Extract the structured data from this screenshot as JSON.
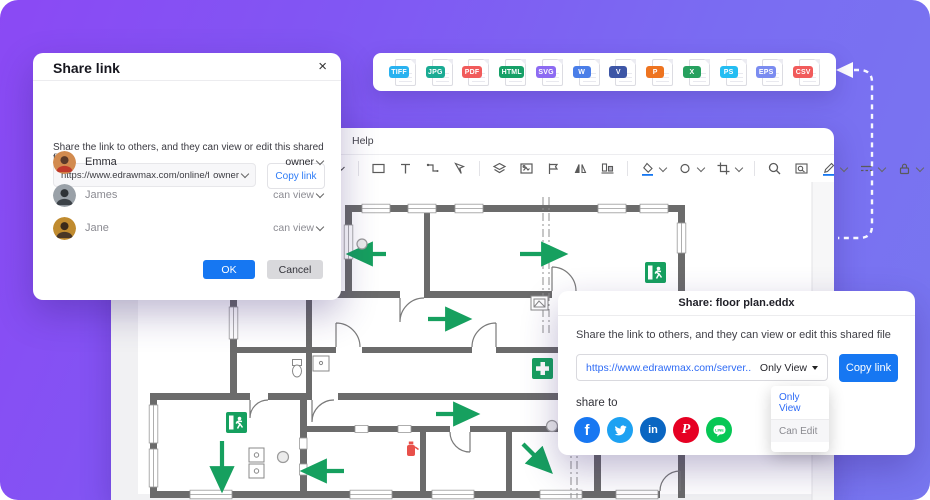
{
  "colors": {
    "accent_blue": "#1677f2",
    "link_blue": "#2e6bf5",
    "plan_green": "#16a05f",
    "wall_gray": "#6b6b6b",
    "background_gradient": [
      "#8b49f4",
      "#7877f0"
    ]
  },
  "share_link_dialog": {
    "title": "Share link",
    "close_label": "×",
    "description": "Share the link to others, and they can view or edit this shared file",
    "link_value": "https://www.edrawmax.com/online/fil",
    "link_permission": "owner",
    "copy_button": "Copy link",
    "users": [
      {
        "name": "Emma",
        "permission": "owner"
      },
      {
        "name": "James",
        "permission": "can view"
      },
      {
        "name": "Jane",
        "permission": "can view"
      }
    ],
    "ok_button": "OK",
    "cancel_button": "Cancel"
  },
  "format_bar": {
    "items": [
      {
        "label": "TIFF",
        "color": "#29b2f0"
      },
      {
        "label": "JPG",
        "color": "#1aab93"
      },
      {
        "label": "PDF",
        "color": "#f15b5b"
      },
      {
        "label": "HTML",
        "color": "#16a067"
      },
      {
        "label": "SVG",
        "color": "#8d6bf2"
      },
      {
        "label": "W",
        "color": "#4a7ee8"
      },
      {
        "label": "V",
        "color": "#3d56a6"
      },
      {
        "label": "P",
        "color": "#ee7420"
      },
      {
        "label": "X",
        "color": "#27a15f"
      },
      {
        "label": "PS",
        "color": "#24bdf2"
      },
      {
        "label": "EPS",
        "color": "#7b8cf0"
      },
      {
        "label": "CSV",
        "color": "#f15b5b"
      }
    ]
  },
  "editor": {
    "menu": [
      "Help"
    ],
    "toolbar_icons": [
      "dropdown-caret",
      "rectangle-tool",
      "text-tool",
      "connector-tool",
      "lasso-tool",
      "layers",
      "insert-image",
      "align-flag",
      "mirror",
      "align-shapes",
      "fill-color",
      "shape-style",
      "crop",
      "zoom",
      "find-replace",
      "pen-style",
      "line-style",
      "lock",
      "focus-mode",
      "group-objects"
    ],
    "canvas_content": "evacuation floor plan drawing"
  },
  "share_file_dialog": {
    "title": "Share: floor plan.eddx",
    "description": "Share the link to others, and they can view or edit this shared file",
    "link_value": "https://www.edrawmax.com/server..",
    "link_permission": "Only View",
    "copy_button": "Copy link",
    "share_to_label": "share to",
    "social": [
      {
        "name": "facebook",
        "color": "#1877F2"
      },
      {
        "name": "twitter",
        "color": "#1DA1F2"
      },
      {
        "name": "linkedin",
        "color": "#0A66C2"
      },
      {
        "name": "pinterest",
        "color": "#E60023"
      },
      {
        "name": "line",
        "color": "#06C755"
      }
    ],
    "permission_options": [
      "Only View",
      "Can Edit"
    ]
  }
}
